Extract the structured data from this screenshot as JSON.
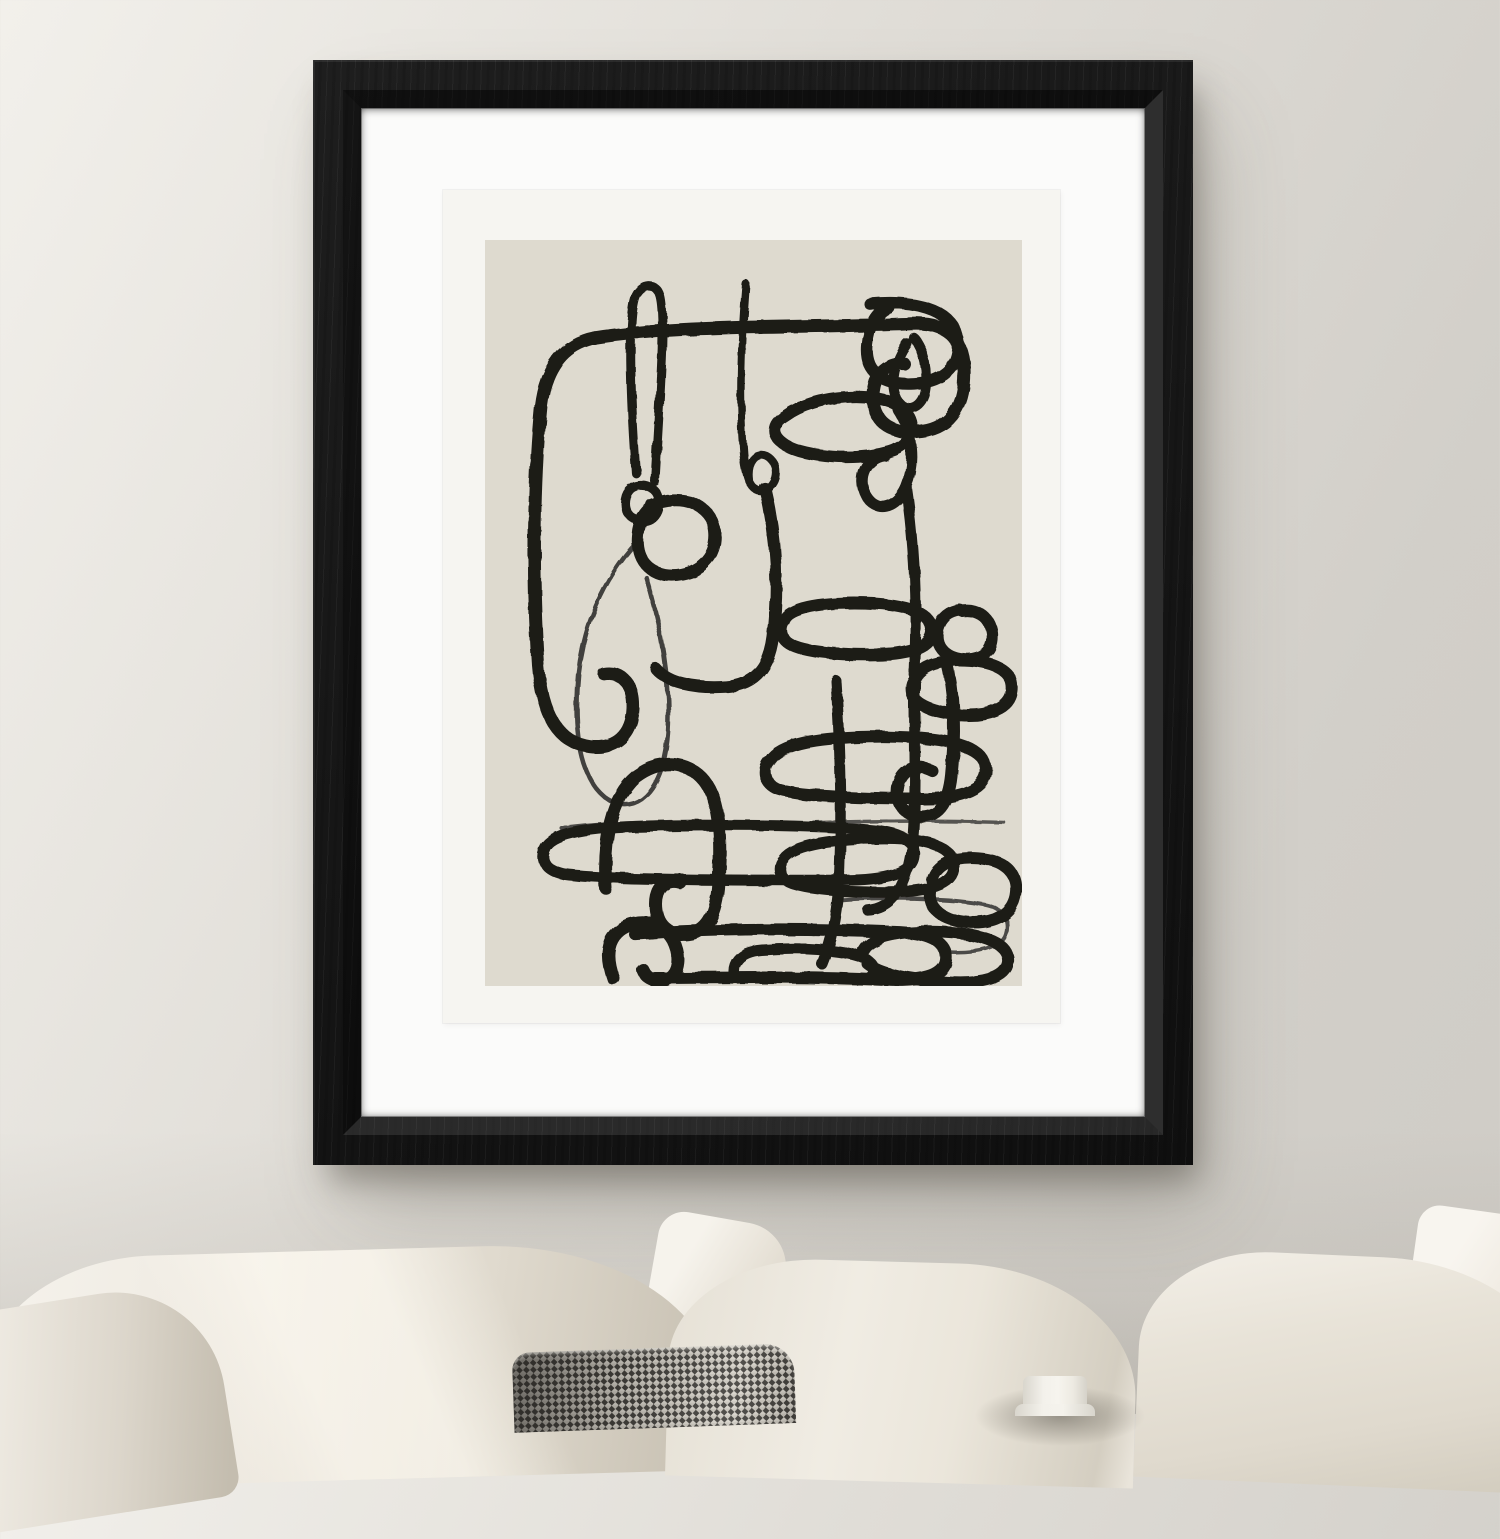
{
  "scene": {
    "description": "Black wood framed abstract continuous-line art print with white mat, hung on a warm gray wall above a sofa with white linen cushions, a gray tweed cushion and a small white ceramic vase",
    "colors": {
      "wall_light": "#F2F0EB",
      "wall_mid": "#E0DDD7",
      "wall_dark": "#D2CFC9",
      "frame_black": "#171717",
      "frame_hi": "#2E2E2E",
      "mat_white": "#FBFBFA",
      "paper_white": "#F6F5F1",
      "art_bg": "#DEDACF",
      "art_line": "#1C1B18",
      "pillow_bright": "#F6F3EC",
      "pillow_light": "#EDE8DF",
      "pillow_mid": "#DFD9CD",
      "pillow_dark": "#C9C2B4",
      "tweed_dark": "#3E3C38",
      "tweed_light": "#D6D2C9",
      "vase_light": "#F3F1EB",
      "vase_shade": "#D9D6CD"
    },
    "artwork": {
      "style": "abstract one-line charcoal brush doodle, interlocking loops, chains and rounded rectangles",
      "viewbox": "0 0 537 748",
      "strokes": [
        {
          "w": 13,
          "d": "M110,98 C200,84 340,88 426,84 C462,82 477,98 479,128 C481,164 467,188 437,192 C409,196 389,184 388,160 C387,136 401,122 419,124"
        },
        {
          "w": 13,
          "d": "M110,98 C80,104 61,126 56,166 C49,236 47,336 53,426 C57,476 73,504 105,508 C131,511 147,496 148,470 C149,446 137,432 119,435"
        },
        {
          "w": 9,
          "d": "M151,234 C145,154 143,74 151,56 C157,44 171,42 175,56 C181,78 175,154 170,242"
        },
        {
          "w": 9,
          "d": "M156,246 C146,246 140,254 140,264 C140,275 149,282 158,282 C168,282 174,273 174,263 C174,252 166,246 156,246"
        },
        {
          "w": 12,
          "d": "M167,266 C195,254 227,264 230,292 C233,318 213,336 187,336 C164,336 151,320 153,297 C154,283 159,274 167,268"
        },
        {
          "w": 4.5,
          "o": 0.8,
          "d": "M153,302 C119,338 95,390 92,450 C89,510 101,552 129,564 C156,574 179,548 183,494 C186,444 176,386 161,338"
        },
        {
          "w": 8,
          "d": "M261,44 C257,94 254,152 258,208 C260,244 269,256 281,250 C294,243 294,223 282,217 C271,212 262,223 264,240"
        },
        {
          "w": 12,
          "d": "M280,249 C292,300 294,350 288,398 C284,430 269,446 241,448 C209,450 183,444 171,430"
        },
        {
          "w": 12,
          "d": "M385,64 C427,60 465,68 472,96 C478,124 461,142 429,144 C397,146 380,132 382,106 C384,86 392,72 404,68"
        },
        {
          "w": 10,
          "d": "M429,98 C439,110 444,132 440,152 C436,170 420,174 412,160 C404,144 410,120 422,104"
        },
        {
          "w": 12,
          "d": "M301,176 C331,154 391,152 413,166 C435,180 431,204 405,212 C371,222 321,218 301,206 C285,196 287,184 301,176"
        },
        {
          "w": 11,
          "d": "M413,170 C428,192 431,224 421,248 C411,270 391,274 381,256 C371,238 382,218 399,216"
        },
        {
          "w": 11,
          "d": "M421,248 C429,302 432,362 430,422 C428,472 432,532 429,582 C427,638 413,670 383,672"
        },
        {
          "w": 12,
          "d": "M285,522 C295,506 329,498 397,498 C465,498 499,508 501,530 C503,550 477,560 439,560 C379,560 309,558 291,550 C279,544 277,530 285,522"
        },
        {
          "w": 3.5,
          "o": 0.7,
          "d": "M291,586 C369,582 449,582 519,584"
        },
        {
          "w": 11,
          "d": "M299,620 C309,606 349,600 399,600 C447,600 469,610 469,628 C469,646 445,654 403,654 C351,654 311,650 301,642 C293,636 293,626 299,620"
        },
        {
          "w": 11,
          "d": "M351,442 C355,502 357,562 355,622 C354,670 347,702 337,726"
        },
        {
          "w": 13,
          "d": "M121,650 C117,602 127,558 151,538 C175,520 203,522 219,542 C235,562 237,602 233,650 C230,678 221,694 203,696 C183,698 171,686 171,666 C171,650 181,640 195,644"
        },
        {
          "w": 11,
          "d": "M59,612 C63,598 89,590 149,588 C229,586 329,586 389,592 C419,595 431,604 429,618 C427,634 403,642 359,642 C259,642 119,642 79,636 C61,632 55,622 59,612"
        },
        {
          "w": 4,
          "o": 0.75,
          "d": "M77,590 C119,584 199,582 259,584"
        },
        {
          "w": 13,
          "d": "M128,740 C120,718 122,700 138,690 C156,680 178,684 188,702 C196,718 194,734 184,740 C174,746 162,742 158,732"
        },
        {
          "w": 12,
          "d": "M150,696 C225,690 330,690 415,694 C449,696 463,706 461,722 C459,738 435,744 401,742 C320,738 220,740 170,740"
        },
        {
          "w": 11,
          "d": "M250,740 C246,726 254,714 276,712 C312,709 358,711 377,719 C391,725 393,737 383,741"
        },
        {
          "w": 4,
          "o": 0.75,
          "d": "M351,662 C399,658 469,660 499,666 C519,670 525,682 521,696 C517,710 493,716 459,714"
        },
        {
          "w": 12,
          "d": "M299,382 C303,370 329,364 369,364 C417,364 445,372 447,390 C449,408 425,416 385,416 C343,416 307,412 299,400 C295,394 295,388 299,382"
        },
        {
          "w": 12,
          "d": "M477,372 C489,370 505,376 507,394 C509,414 495,422 477,420 C459,418 449,406 453,390 C456,378 465,372 475,371"
        },
        {
          "w": 12,
          "d": "M429,442 C435,426 457,420 485,422 C513,424 529,434 527,452 C525,470 503,478 475,476 C449,474 429,466 427,454 C426,448 427,444 429,442"
        },
        {
          "w": 12,
          "d": "M461,420 C469,452 471,492 467,532 C465,562 455,578 437,578 C419,578 409,564 413,546 C417,530 433,524 447,532"
        },
        {
          "w": 12,
          "d": "M447,642 C451,626 469,618 493,620 C519,622 533,634 531,654 C529,676 509,686 483,684 C457,682 443,670 445,654"
        },
        {
          "w": 12,
          "d": "M379,712 C387,698 419,692 459,694 C501,696 525,706 523,724 C521,740 497,746 463,744 C425,742 395,736 383,726"
        }
      ]
    }
  }
}
